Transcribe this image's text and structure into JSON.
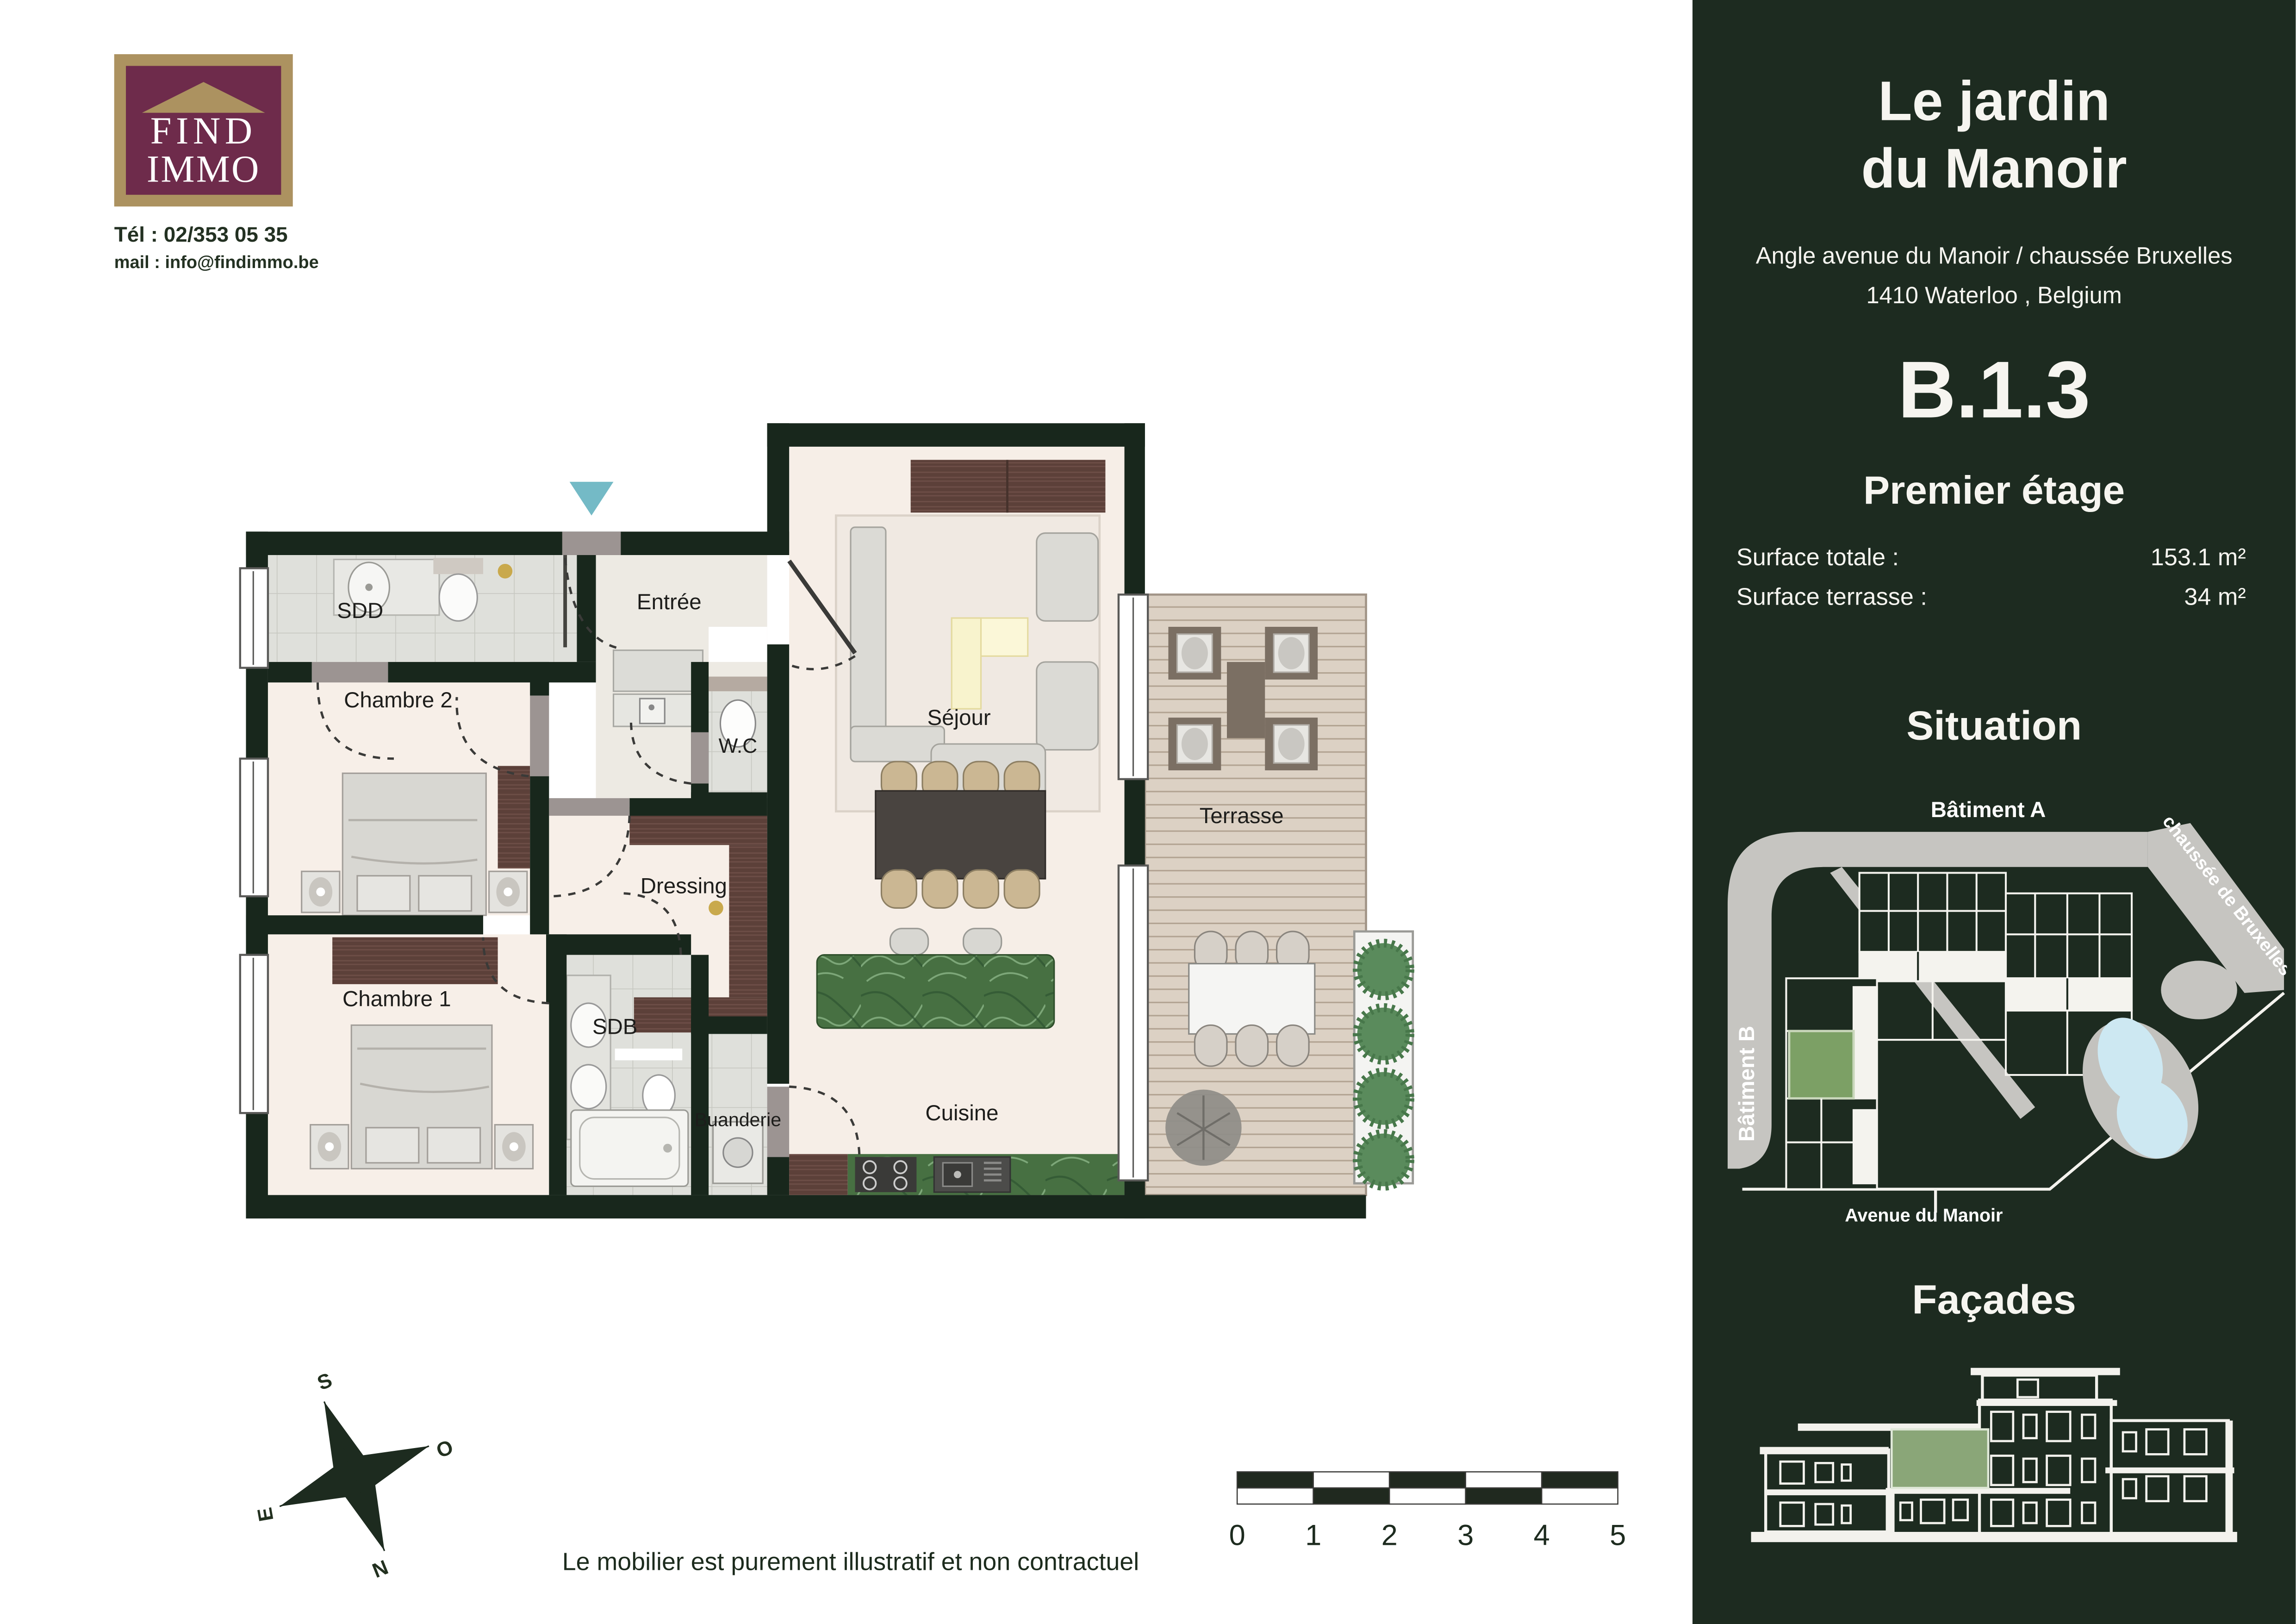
{
  "logo": {
    "brand_line1": "FIND",
    "brand_line2": "IMMO",
    "tel": "Tél : 02/353 05 35",
    "mail": "mail : info@findimmo.be"
  },
  "panel": {
    "title_line1": "Le jardin",
    "title_line2": "du Manoir",
    "address_line1": "Angle avenue du Manoir / chaussée Bruxelles",
    "address_line2": "1410 Waterloo , Belgium",
    "unit_code": "B.1.3",
    "floor_label": "Premier étage",
    "surface_total_label": "Surface totale :",
    "surface_total_value": "153.1 m²",
    "surface_terrace_label": "Surface terrasse :",
    "surface_terrace_value": "34 m²",
    "situation_title": "Situation",
    "facades_title": "Façades",
    "map": {
      "batiment_a": "Bâtiment A",
      "batiment_b": "Bâtiment B",
      "chaussee": "chaussée de Bruxelles",
      "avenue": "Avenue du Manoir"
    }
  },
  "plan": {
    "labels": {
      "sdd": "SDD",
      "chambre2": "Chambre 2",
      "entree": "Entrée",
      "wc": "W.C",
      "sejour": "Séjour",
      "terrasse": "Terrasse",
      "dressing": "Dressing",
      "chambre1": "Chambre 1",
      "sdb": "SDB",
      "buanderie": "Buanderie",
      "cuisine": "Cuisine"
    }
  },
  "compass": {
    "s": "S",
    "o": "O",
    "e": "E",
    "n": "N"
  },
  "scale_bar": {
    "labels": [
      "0",
      "1",
      "2",
      "3",
      "4",
      "5"
    ]
  },
  "footer": {
    "disclaimer": "Le mobilier est purement illustratif et non contractuel"
  },
  "colors": {
    "panel_bg": "#1d2b20",
    "wall": "#18271c",
    "accent_teal": "#74bac6",
    "logo_purple": "#6e2b4b",
    "logo_tan": "#ac9260",
    "highlight_green": "#7ca065",
    "pond_blue": "#cde8f2",
    "marble_green": "#477042",
    "deck": "#dcd1c4"
  }
}
